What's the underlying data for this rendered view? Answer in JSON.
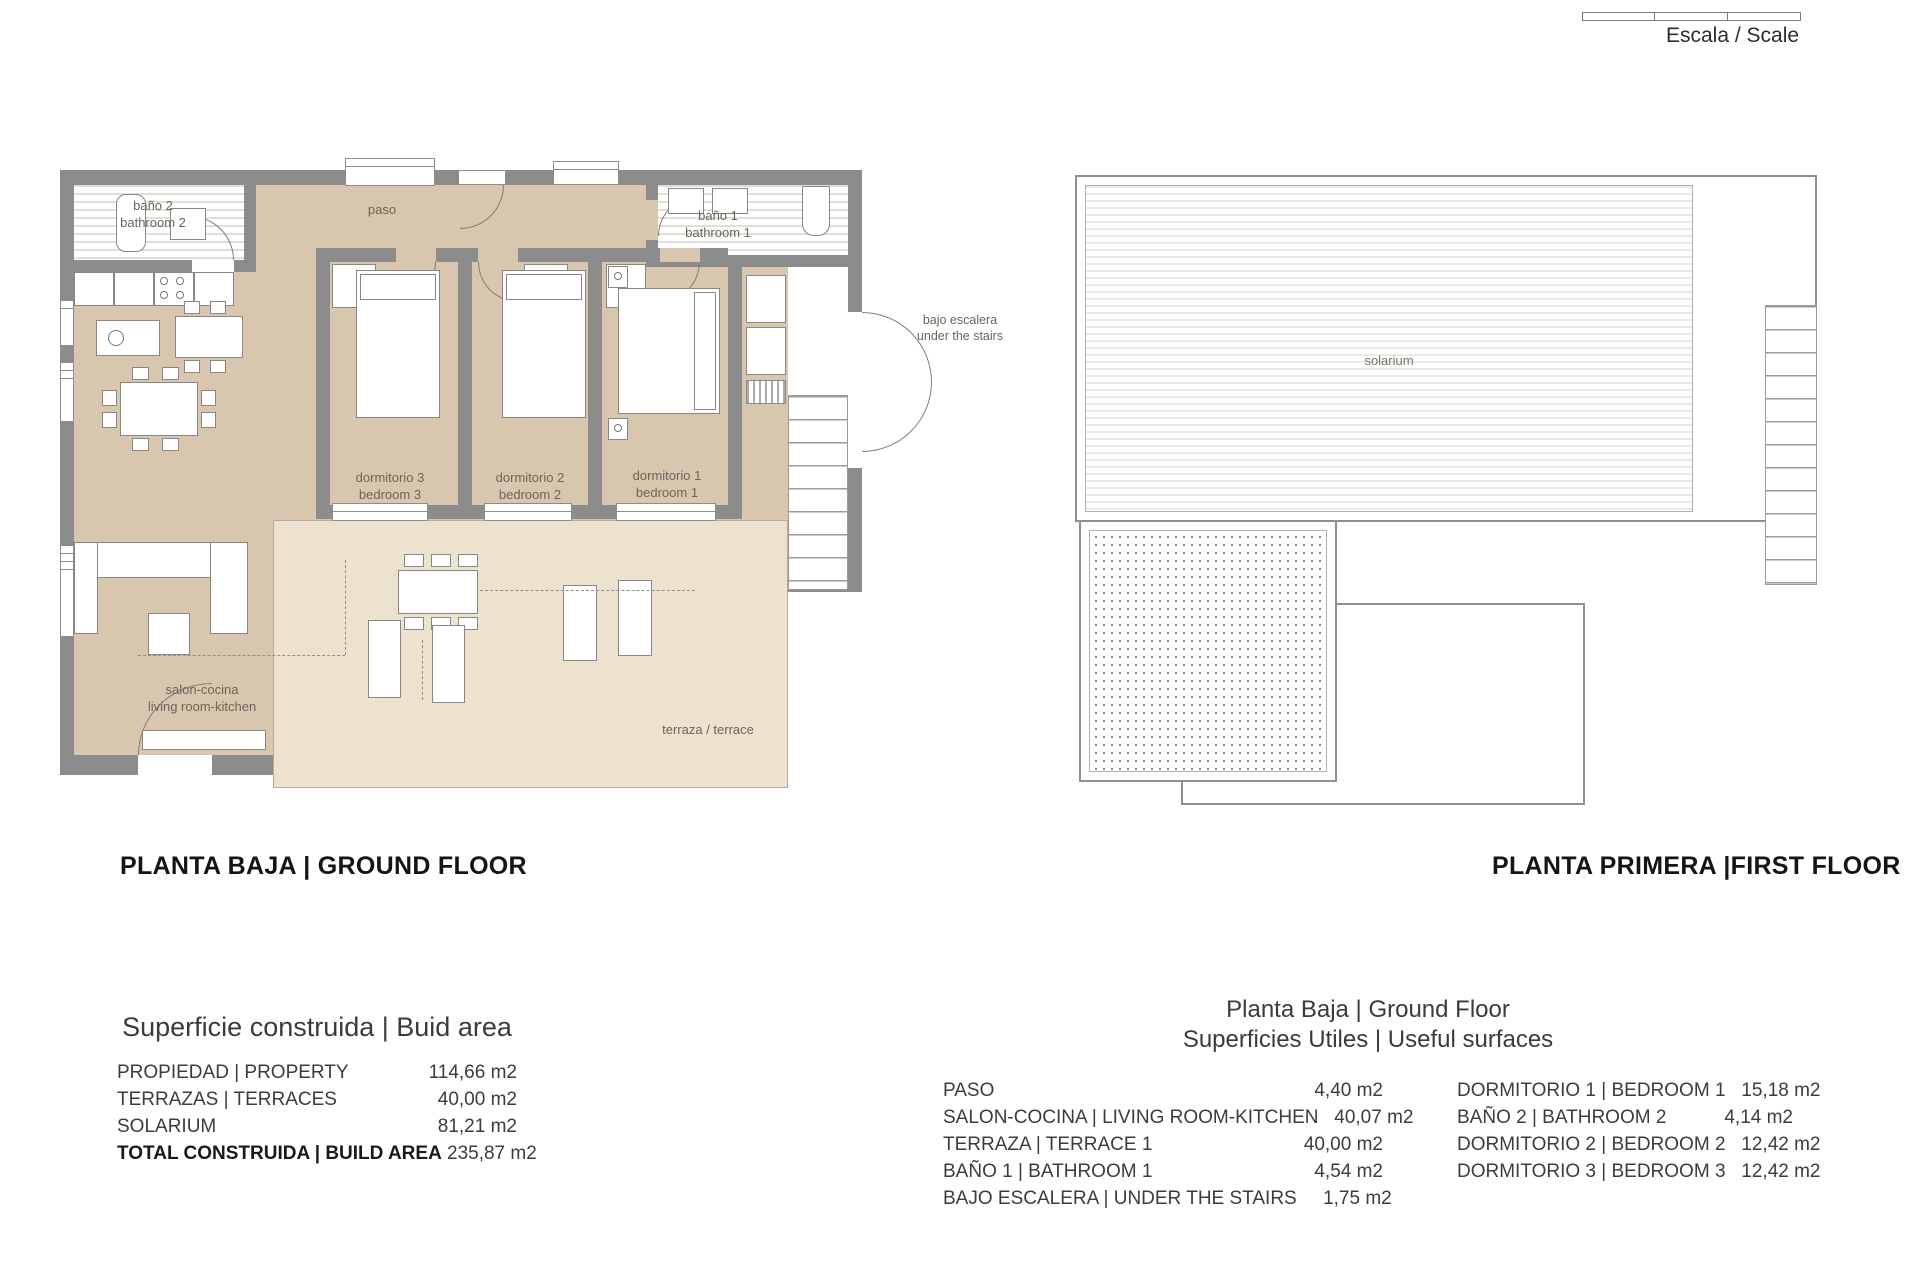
{
  "scale_bar": {
    "label": "Escala / Scale"
  },
  "titles": {
    "ground_floor": "PLANTA BAJA | GROUND FLOOR",
    "first_floor": "PLANTA PRIMERA |FIRST FLOOR"
  },
  "ground_floor_rooms": {
    "bano2_l1": "baño 2",
    "bano2_l2": "bathroom 2",
    "paso": "paso",
    "bano1_l1": "baño 1",
    "bano1_l2": "bathroom 1",
    "bajo_l1": "bajo escalera",
    "bajo_l2": "under the stairs",
    "dorm3_l1": "dormitorio 3",
    "dorm3_l2": "bedroom 3",
    "dorm2_l1": "dormitorio 2",
    "dorm2_l2": "bedroom 2",
    "dorm1_l1": "dormitorio 1",
    "dorm1_l2": "bedroom 1",
    "salon_l1": "salon-cocina",
    "salon_l2": "living room-kitchen",
    "terraza": "terraza / terrace"
  },
  "first_floor_rooms": {
    "solarium": "solarium"
  },
  "build_area": {
    "title": "Superficie construida | Buid area",
    "rows": [
      {
        "label": "PROPIEDAD | PROPERTY",
        "value": "114,66 m2"
      },
      {
        "label": "TERRAZAS | TERRACES",
        "value": "40,00 m2"
      },
      {
        "label": "SOLARIUM",
        "value": "81,21 m2"
      },
      {
        "label": "TOTAL CONSTRUIDA | BUILD AREA",
        "value": "235,87 m2"
      }
    ]
  },
  "useful_surfaces": {
    "title_l1": "Planta Baja | Ground Floor",
    "title_l2": "Superficies Utiles | Useful surfaces",
    "left_rows": [
      {
        "label": "PASO",
        "value": "4,40 m2"
      },
      {
        "label": "SALON-COCINA | LIVING ROOM-KITCHEN",
        "value": "40,07 m2"
      },
      {
        "label": "TERRAZA | TERRACE 1",
        "value": "40,00 m2"
      },
      {
        "label": "BAÑO 1 | BATHROOM 1",
        "value": "4,54 m2"
      },
      {
        "label": "BAJO ESCALERA | UNDER THE STAIRS",
        "value": "1,75 m2"
      }
    ],
    "right_rows": [
      {
        "label": "DORMITORIO 1 | BEDROOM 1",
        "value": "15,18 m2"
      },
      {
        "label": "BAÑO 2 | BATHROOM 2",
        "value": "4,14 m2"
      },
      {
        "label": "DORMITORIO 2 | BEDROOM 2",
        "value": "12,42 m2"
      },
      {
        "label": "DORMITORIO 3 | BEDROOM 3",
        "value": "12,42 m2"
      }
    ]
  },
  "colors": {
    "wall": "#8c8c8c",
    "room_fill": "#d8c7ae",
    "terrace_fill": "#ece2cd"
  }
}
